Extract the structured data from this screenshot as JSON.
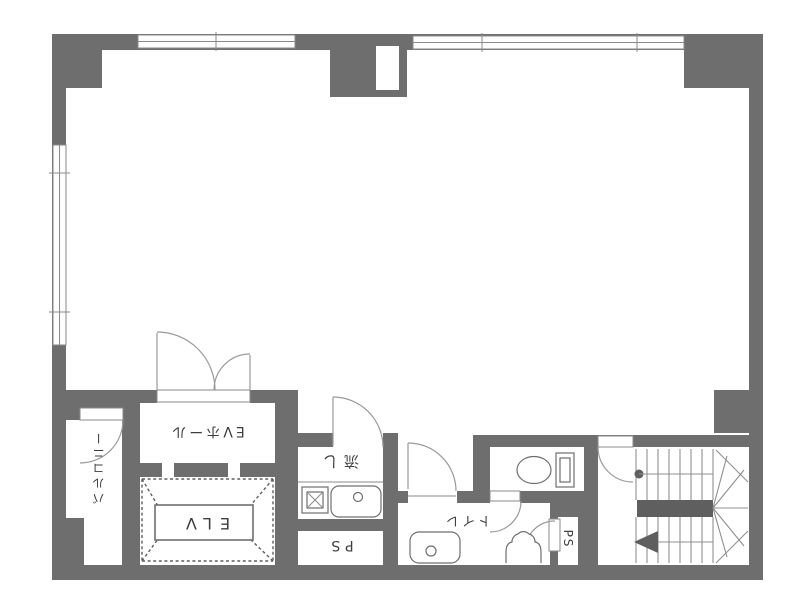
{
  "plan": {
    "kind": "architectural floor plan (Japanese)",
    "colors": {
      "wall": "#6e6e6e",
      "floor": "#ffffff",
      "fixture_line": "#6f6f6f",
      "label_text": "#3e3e3e"
    },
    "rooms": {
      "balcony": {
        "label": "バルコニー"
      },
      "ev_hall": {
        "label": "EVホール"
      },
      "elevator": {
        "label": "ELV"
      },
      "kitchen_sink": {
        "label": "流し"
      },
      "pipe_space_kitchen": {
        "label": "PS"
      },
      "toilet_lobby": {
        "label": "トイレ"
      },
      "pipe_space_stairs": {
        "label": "PS"
      }
    },
    "features": [
      "large open main room",
      "double-swing entrance doors to elevator hall",
      "elevator shaft drawn with dashed X cross",
      "kitchen counter with stove and sink",
      "toilet room with water closet",
      "washbasin and hand basin in toilet lobby",
      "U-shaped staircase with winder treads and up arrow",
      "windows along top and left outer walls"
    ]
  }
}
